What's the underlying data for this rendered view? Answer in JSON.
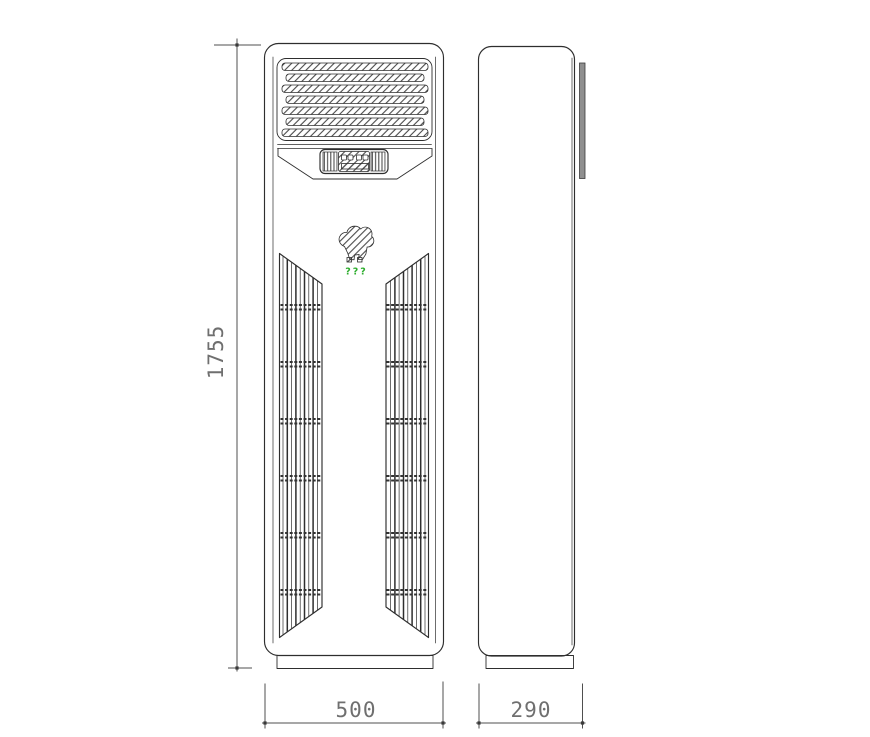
{
  "dimensions": {
    "height": "1755",
    "width": "500",
    "depth": "290"
  },
  "logo_caption": "???",
  "colors": {
    "line": "#2e2e2e",
    "dim": "#4f4f4f",
    "dimtext": "#6f6f6f",
    "green": "#2fae2f",
    "strip": "#8f8f8f",
    "background": "#ffffff"
  }
}
